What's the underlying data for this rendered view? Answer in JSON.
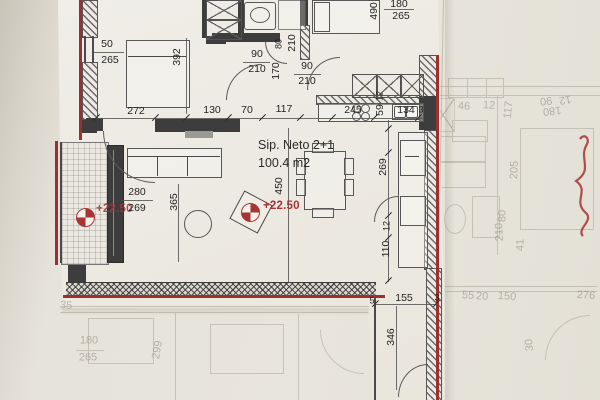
{
  "title": {
    "room_name": "Sip. Neto 2+1",
    "room_area": "100.4 m2"
  },
  "level_markers": {
    "left": "+22.50",
    "center": "+22.50"
  },
  "colors": {
    "accent_red": "#9e2f2f",
    "wall_dark": "#3d3d3d",
    "paper": "#ebe8e0",
    "underlay_ink": "#8b8678",
    "ink": "#242424"
  },
  "dimensions": [
    {
      "t": "50",
      "x": 107,
      "y": 44
    },
    {
      "t": "265",
      "x": 110,
      "y": 60
    },
    {
      "t": "392",
      "x": 177,
      "y": 57,
      "r": -90
    },
    {
      "t": "272",
      "x": 136,
      "y": 111
    },
    {
      "t": "130",
      "x": 212,
      "y": 110
    },
    {
      "t": "70",
      "x": 247,
      "y": 110
    },
    {
      "t": "117",
      "x": 284,
      "y": 109
    },
    {
      "t": "90",
      "x": 257,
      "y": 54
    },
    {
      "t": "210",
      "x": 257,
      "y": 69
    },
    {
      "t": "80",
      "x": 279,
      "y": 44,
      "r": -90,
      "s": 1
    },
    {
      "t": "210",
      "x": 292,
      "y": 43,
      "r": -90
    },
    {
      "t": "170",
      "x": 276,
      "y": 71,
      "r": -90
    },
    {
      "t": "90",
      "x": 307,
      "y": 66
    },
    {
      "t": "210",
      "x": 307,
      "y": 81
    },
    {
      "t": "490",
      "x": 374,
      "y": 11,
      "r": -90
    },
    {
      "t": "180",
      "x": 399,
      "y": 4
    },
    {
      "t": "265",
      "x": 401,
      "y": 16
    },
    {
      "t": "245",
      "x": 353,
      "y": 110
    },
    {
      "t": "12",
      "x": 380,
      "y": 96,
      "r": -90,
      "s": 1
    },
    {
      "t": "59",
      "x": 380,
      "y": 110,
      "r": -90
    },
    {
      "t": "134",
      "x": 406,
      "y": 110
    },
    {
      "t": "3",
      "x": 421,
      "y": 110,
      "s": 1
    },
    {
      "t": "280",
      "x": 137,
      "y": 192
    },
    {
      "t": "269",
      "x": 137,
      "y": 208
    },
    {
      "t": "365",
      "x": 174,
      "y": 202,
      "r": -90
    },
    {
      "t": "450",
      "x": 279,
      "y": 186,
      "r": -90
    },
    {
      "t": "269",
      "x": 383,
      "y": 167,
      "r": -90
    },
    {
      "t": "12",
      "x": 387,
      "y": 226,
      "r": -90,
      "s": 1
    },
    {
      "t": "110",
      "x": 386,
      "y": 249,
      "r": -90
    },
    {
      "t": "155",
      "x": 404,
      "y": 298
    },
    {
      "t": "5",
      "x": 372,
      "y": 301,
      "s": 1
    },
    {
      "t": "3",
      "x": 437,
      "y": 298,
      "s": 1
    },
    {
      "t": "346",
      "x": 391,
      "y": 337,
      "r": -90
    }
  ],
  "faint_dimensions": [
    {
      "t": "35",
      "x": 66,
      "y": 306,
      "r": 6
    },
    {
      "t": "180",
      "x": 89,
      "y": 341
    },
    {
      "t": "265",
      "x": 88,
      "y": 358
    },
    {
      "t": "299",
      "x": 158,
      "y": 350,
      "r": -80
    },
    {
      "t": "55",
      "x": 468,
      "y": 296,
      "r": 4
    },
    {
      "t": "20",
      "x": 482,
      "y": 297,
      "r": 4
    },
    {
      "t": "150",
      "x": 507,
      "y": 297,
      "r": 4
    },
    {
      "t": "276",
      "x": 586,
      "y": 296,
      "r": 4
    },
    {
      "t": "30",
      "x": 530,
      "y": 345,
      "r": -95
    },
    {
      "t": "46",
      "x": 464,
      "y": 107,
      "r": 3
    },
    {
      "t": "12",
      "x": 489,
      "y": 106,
      "r": 3
    },
    {
      "t": "117",
      "x": 509,
      "y": 110,
      "r": -84
    },
    {
      "t": "205",
      "x": 515,
      "y": 170,
      "r": -88
    },
    {
      "t": "80",
      "x": 503,
      "y": 216,
      "r": -90
    },
    {
      "t": "210",
      "x": 500,
      "y": 232,
      "r": -92
    },
    {
      "t": "41",
      "x": 521,
      "y": 245,
      "r": -90
    },
    {
      "t": "90",
      "x": 546,
      "y": 100,
      "r": 174
    },
    {
      "t": "180",
      "x": 552,
      "y": 110,
      "r": 174
    },
    {
      "t": "12",
      "x": 565,
      "y": 99,
      "r": 170
    }
  ]
}
